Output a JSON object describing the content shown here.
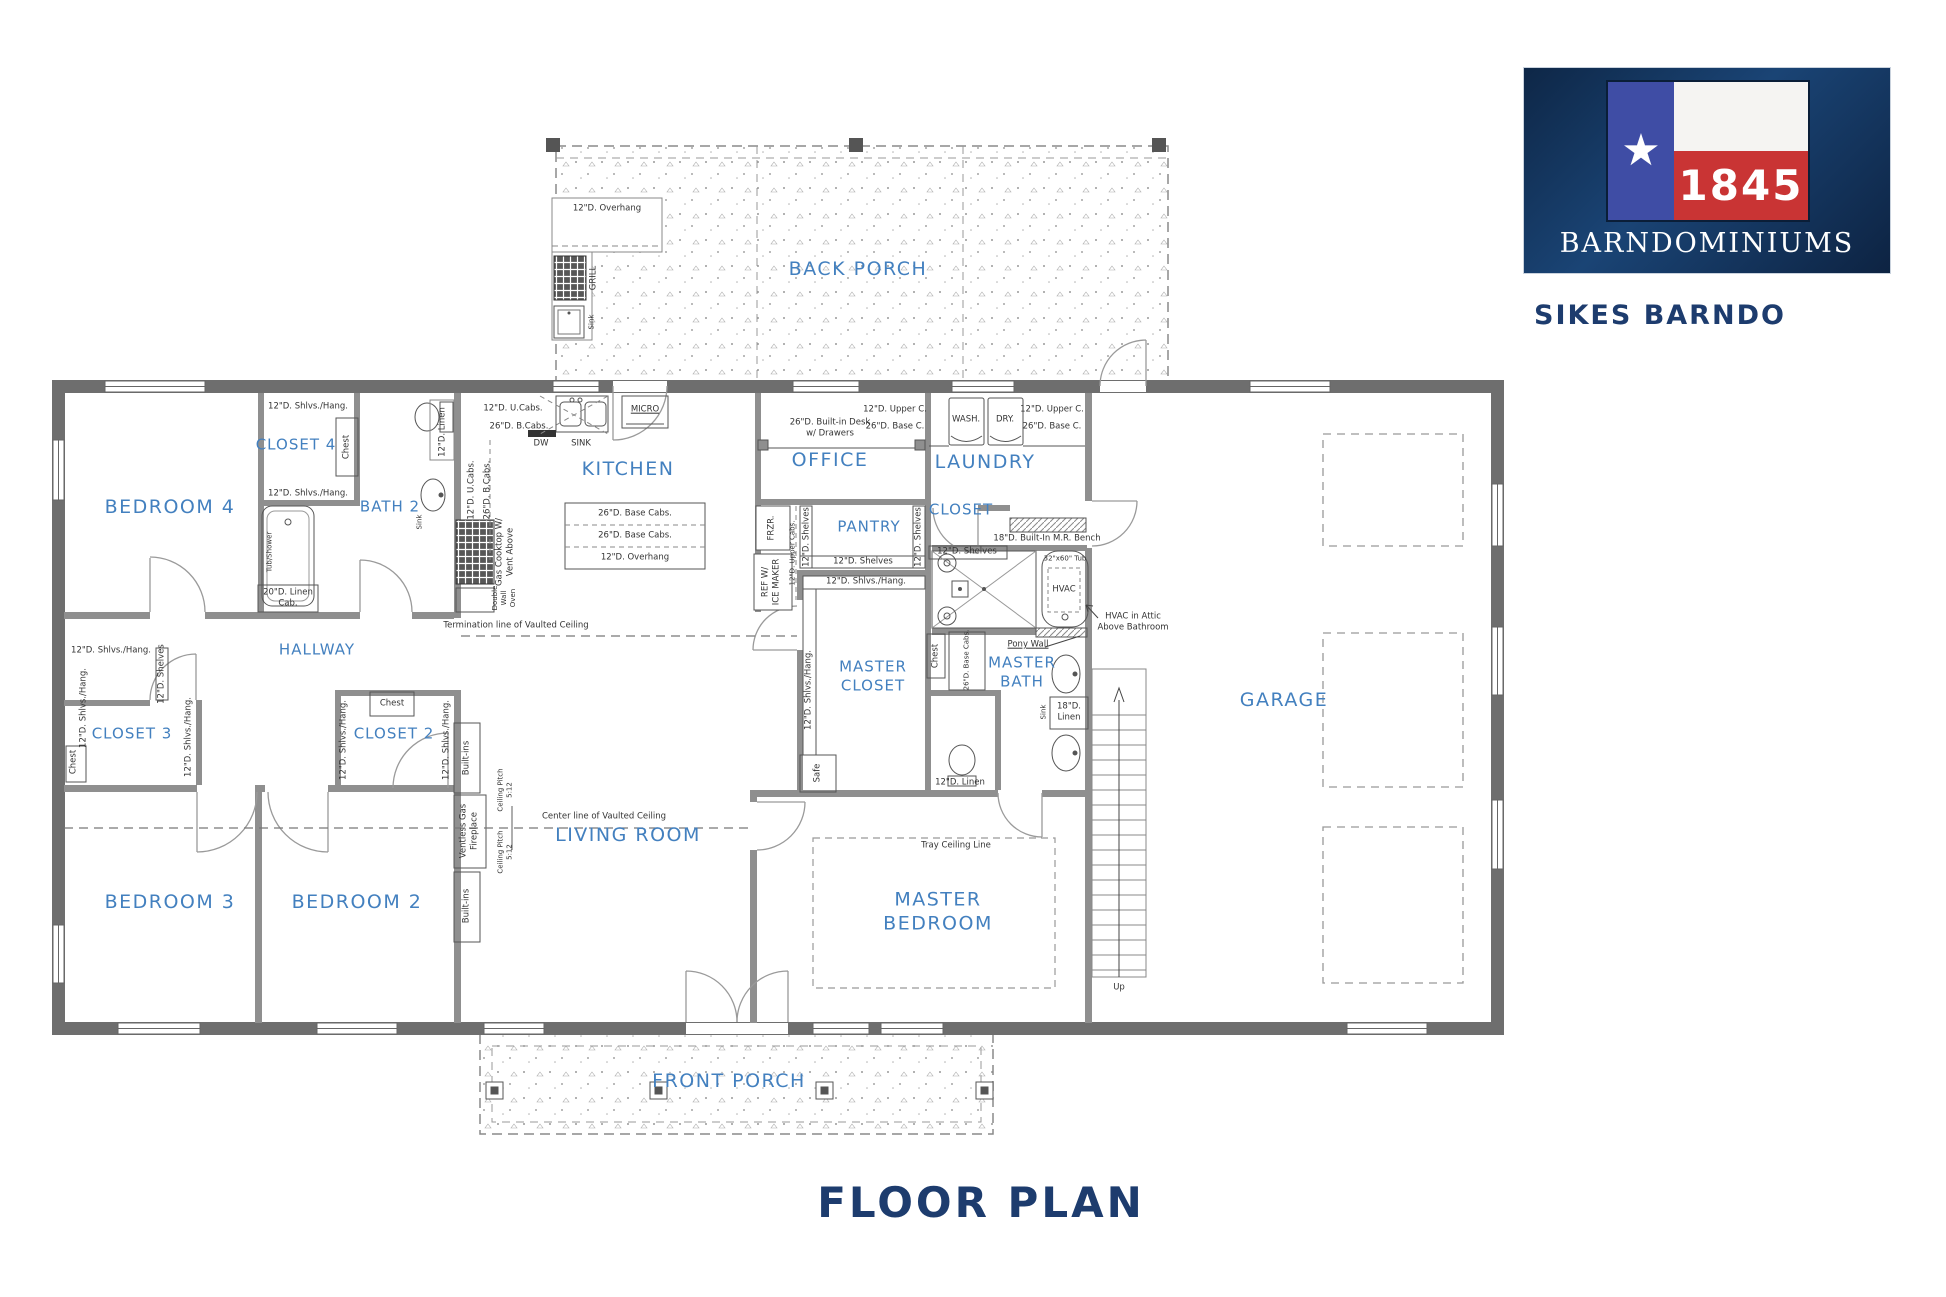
{
  "brand": {
    "logo_year": "1845",
    "logo_name": "BARNDOMINIUMS",
    "plan_name": "SIKES BARNDO"
  },
  "page_title": "FLOOR PLAN",
  "rooms": {
    "back_porch": "BACK PORCH",
    "front_porch": "FRONT PORCH",
    "kitchen": "KITCHEN",
    "office": "OFFICE",
    "laundry": "LAUNDRY",
    "laundry_closet": "CLOSET",
    "pantry": "PANTRY",
    "bedroom4": "BEDROOM 4",
    "closet4": "CLOSET 4",
    "bath2": "BATH 2",
    "hallway": "HALLWAY",
    "closet3": "CLOSET 3",
    "closet2": "CLOSET 2",
    "bedroom3": "BEDROOM 3",
    "bedroom2": "BEDROOM 2",
    "living_room": "LIVING ROOM",
    "master_closet": "MASTER\nCLOSET",
    "master_bath": "MASTER\nBATH",
    "master_bedroom": "MASTER\nBEDROOM",
    "garage": "GARAGE"
  },
  "ann": {
    "overhang12": "12\"D. Overhang",
    "grill": "GRILL",
    "sink_sm": "Sink",
    "ucabs12": "12\"D. U.Cabs.",
    "bcabs26": "26\"D. B.Cabs.",
    "dw": "DW",
    "sink": "SINK",
    "micro": "MICRO",
    "linen12": "12\"D. Linen",
    "gas_cooktop": "Gas Cooktop W/\nVent Above",
    "wall_oven": "Double\nWall\nOven",
    "base_cabs26": "26\"D. Base Cabs.",
    "shlvs_hang": "12\"D. Shlvs./Hang.",
    "shelves12": "12\"D. Shelves",
    "chest": "Chest",
    "tub_shower": "Tub/Shower",
    "linen20": "20\"D. Linen\nCab.",
    "desk": "26\"D. Built-in Desk\nw/ Drawers",
    "upper_c12": "12\"D. Upper C.",
    "base_c26": "26\"D. Base C.",
    "wash": "WASH.",
    "dry": "DRY.",
    "frzr": "FRZR.",
    "ref_ice": "REF W/\nICE MAKER",
    "upper_cabs12": "12\"D. Upper Cabs.",
    "mr_bench": "18\"D. Built-In M.R. Bench",
    "tub3260": "32\"x60\" Tub",
    "hvac": "HVAC",
    "hvac_attic": "HVAC in Attic\nAbove Bathroom",
    "pony_wall": "Pony Wall",
    "safe": "Safe",
    "linen18": "18\"D.\nLinen",
    "linen12t": "12\"D. Linen",
    "up": "Up",
    "tray": "Tray Ceiling Line",
    "term_line": "Termination line of Vaulted Ceiling",
    "center_line": "Center line of Vaulted Ceiling",
    "pitch": "Ceiling Pitch\n5:12",
    "ventless": "Ventless Gas\nFireplace",
    "built_ins": "Built-ins"
  },
  "colors": {
    "room_label": "#4380bf",
    "annotation": "#333333",
    "navy": "#1d3c6e",
    "flag_blue": "#3f4da5",
    "flag_red": "#c93434",
    "wall": "#6e6e6e"
  }
}
